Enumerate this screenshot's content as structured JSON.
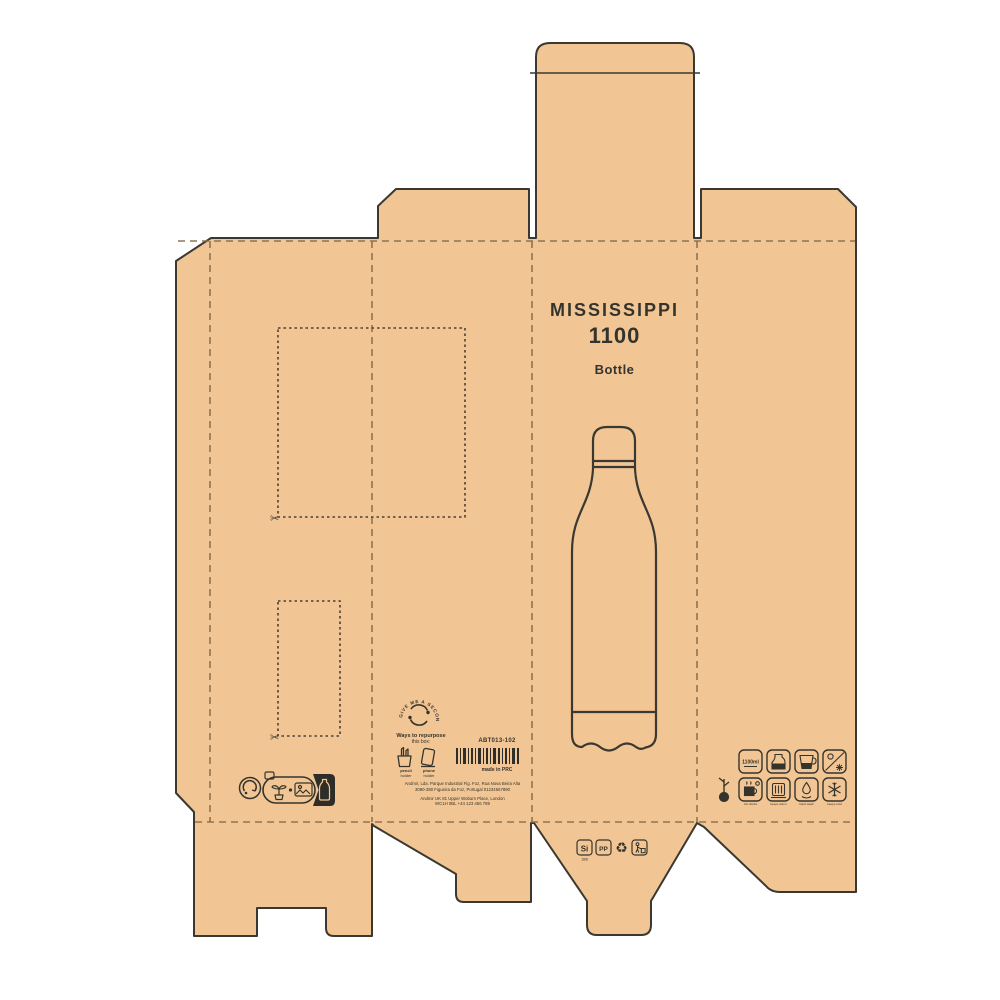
{
  "front": {
    "title": "MISSISSIPPI",
    "capacity": "1100",
    "type": "Bottle"
  },
  "info": {
    "sku": "ABT013-102",
    "origin": "made in PRC",
    "address1": "Andmir, Lda. Parque Industrial Fig. Foz, Rua Nova Beira Alta",
    "address2": "3090-380 Figueira da Foz, Portugal 01234567890",
    "address3": "Andmir UK 81 Upper Woburn Place, London",
    "address4": "WC1H 0BL +44 123 456 789"
  },
  "repurpose": {
    "badge": "GIVE ME A SECOND LIFE",
    "h1": "Ways to repurpose",
    "h2": "this box:",
    "opt1a": "pencil",
    "opt1b": "holder",
    "opt2a": "phone",
    "opt2b": "holder"
  },
  "materials": {
    "steel": "Si",
    "steel_sub": "18/8",
    "plastic": "PP",
    "recycle_glyph": "♻"
  },
  "features": {
    "capacity_label": "1100ml",
    "label_hot": "hot drinks",
    "label_warm": "keeps warm",
    "label_wash": "hand wash",
    "label_cold": "keeps cold"
  },
  "colors": {
    "kraft": "#f2c694",
    "outline": "#3a3831",
    "fold": "#8a6f4e",
    "text": "#35342c"
  }
}
